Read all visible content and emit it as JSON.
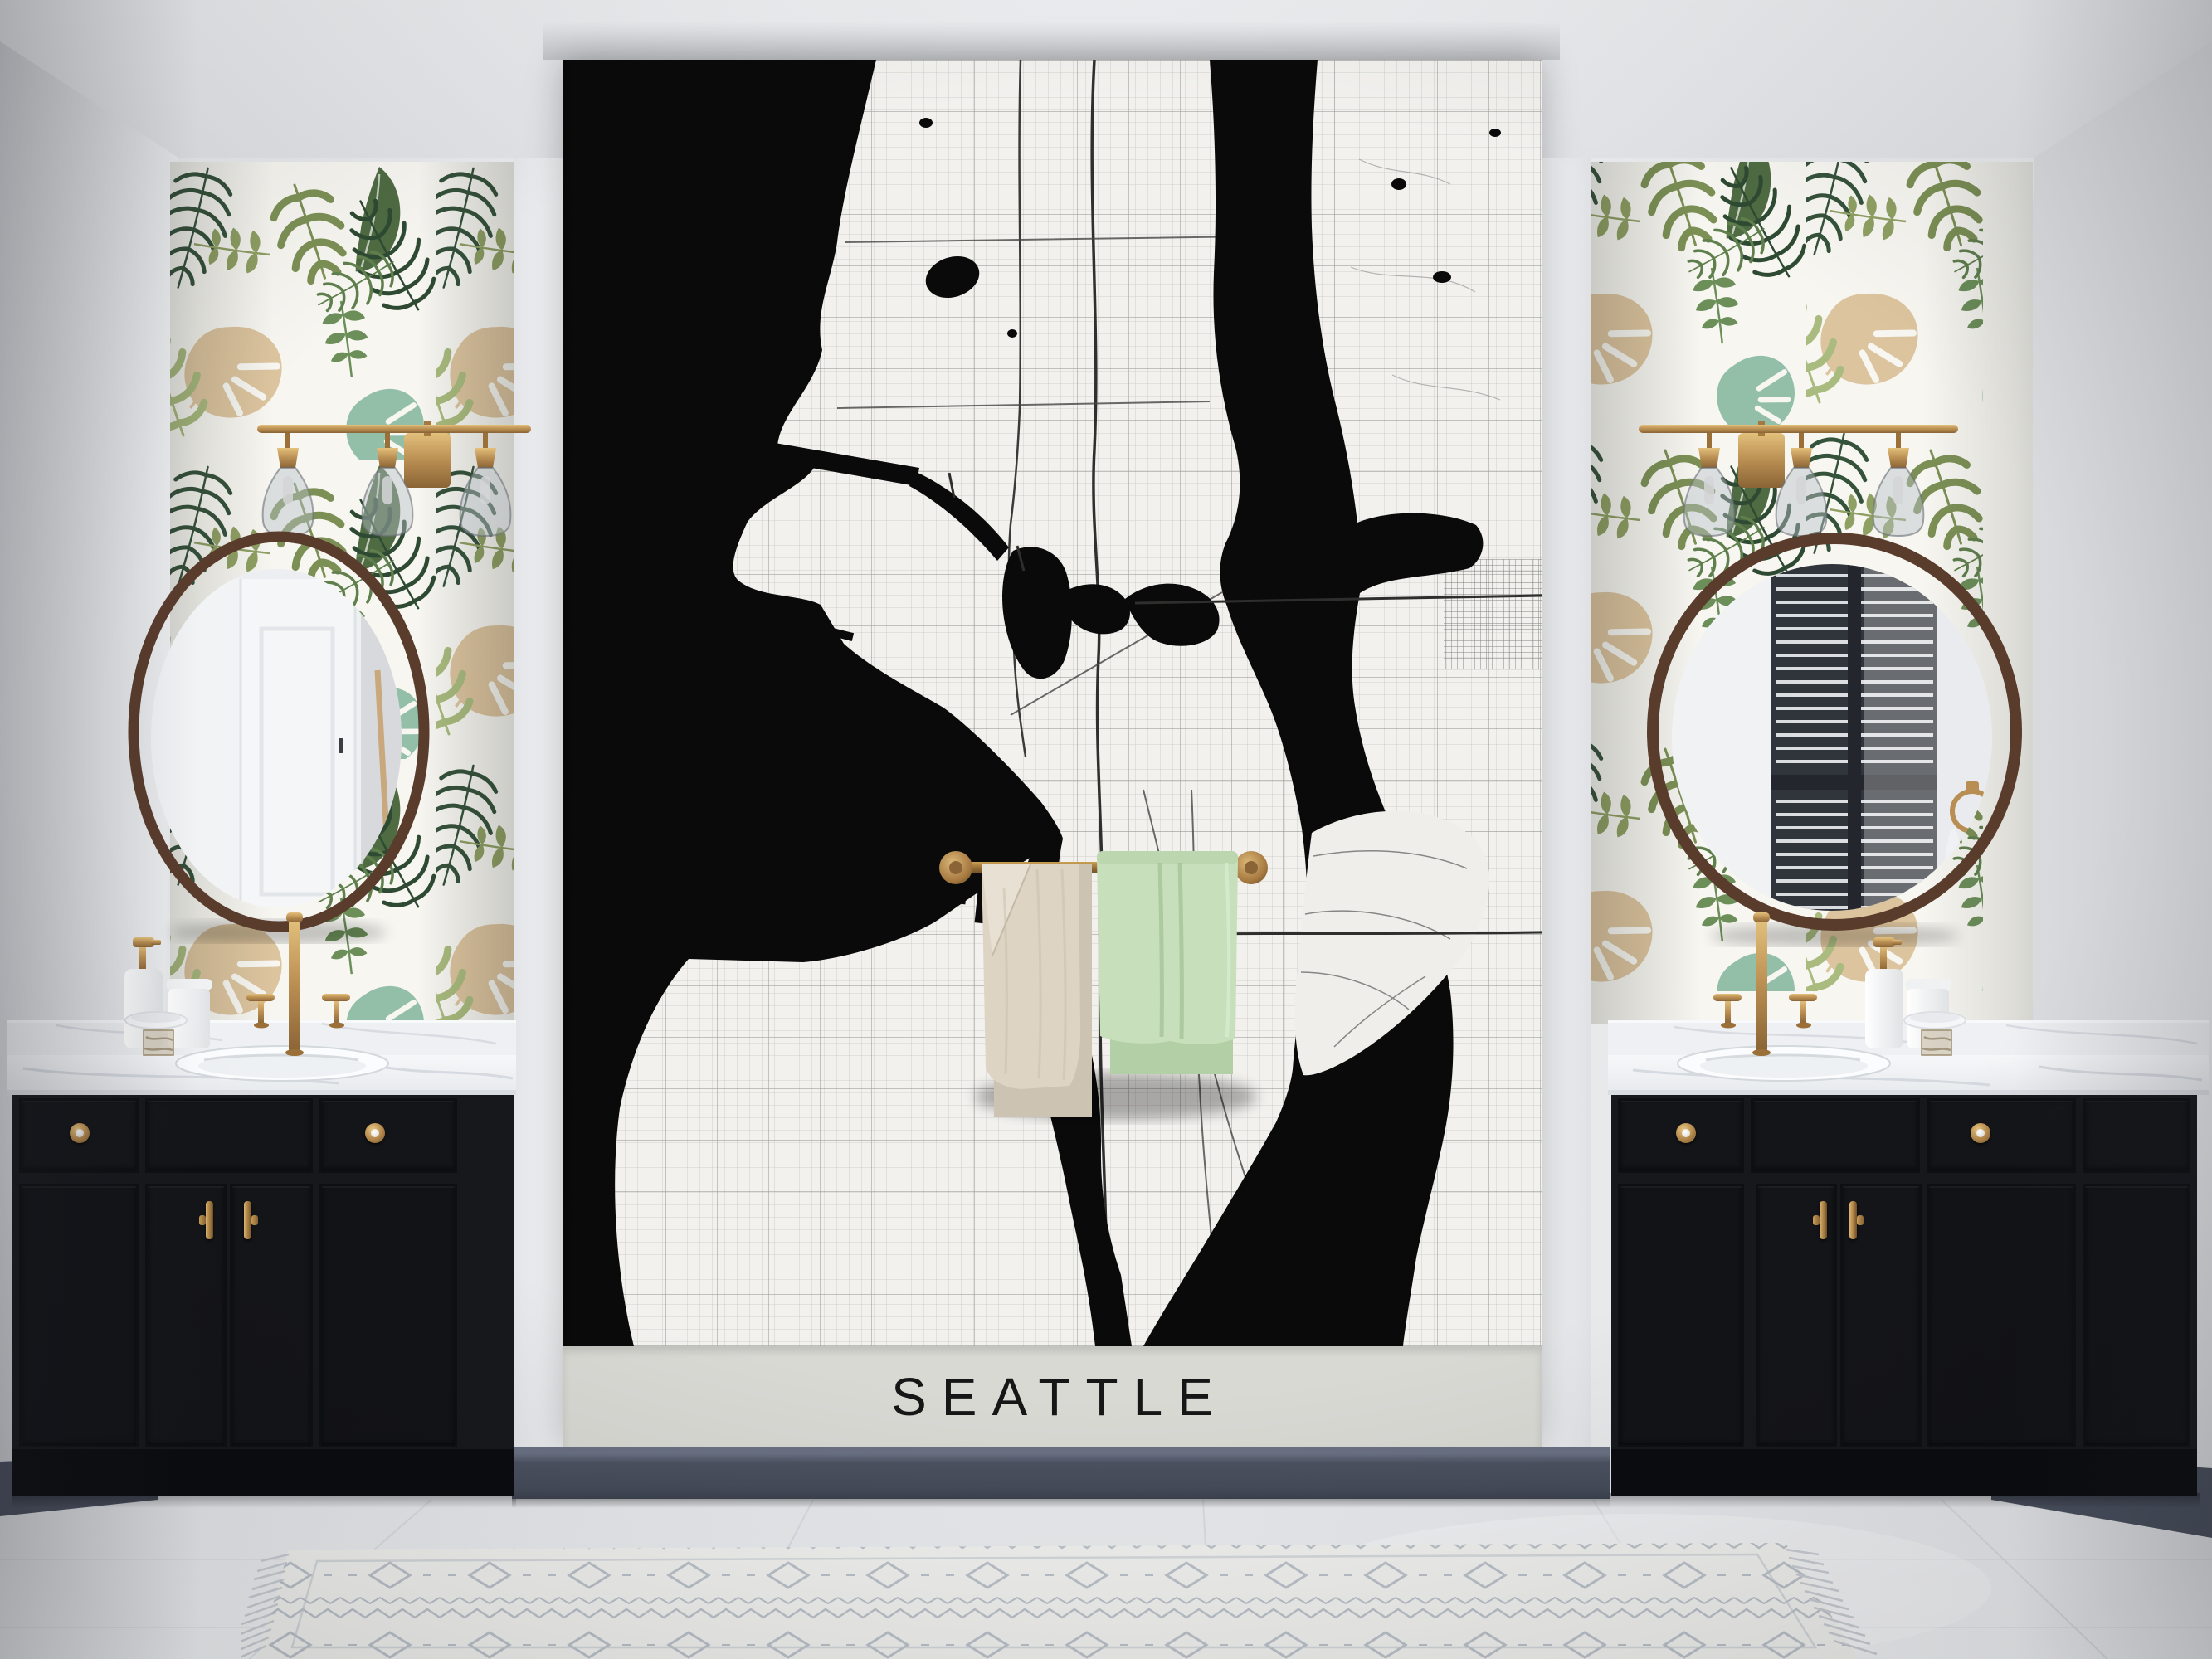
{
  "scene": {
    "description": "Bathroom interior with a black-and-white Seattle street-map mural between two dark vanities, round wood-framed mirrors, brass light fixtures and tropical leaf wallpaper"
  },
  "mural": {
    "title": "SEATTLE"
  },
  "palette": {
    "ceiling": "#e9eaec",
    "side_wall": "#e3e5e8",
    "map_water": "#0a0a0b",
    "map_land": "#f2f1ee",
    "map_band": "#d9d9d4",
    "map_title_color": "#161616",
    "baseboard": "#4c5261",
    "cabinet": "#17181c",
    "toe_kick": "#0b0c0f",
    "counter": "#f1f2f4",
    "brass": "#b98e52",
    "brass_light": "#dcb778",
    "mirror_frame": "#5a3c2c",
    "towel_left": "#ded4c4",
    "towel_right": "#c6deba",
    "floor": "#eef0f3",
    "rug": "#f3f3f1",
    "wallpaper_base": "#f7f6f1",
    "leaf_dark": "#35523b",
    "leaf_olive": "#7c9055",
    "leaf_beige": "#dcc49e",
    "leaf_teal": "#93bfa9"
  },
  "objects": {
    "left_towel": "beige-bath-towel",
    "right_towel": "mint-green-bath-towel",
    "left_mirror_reflection": "white-interior-door",
    "right_mirror_reflection": "window-with-venetian-blinds"
  }
}
